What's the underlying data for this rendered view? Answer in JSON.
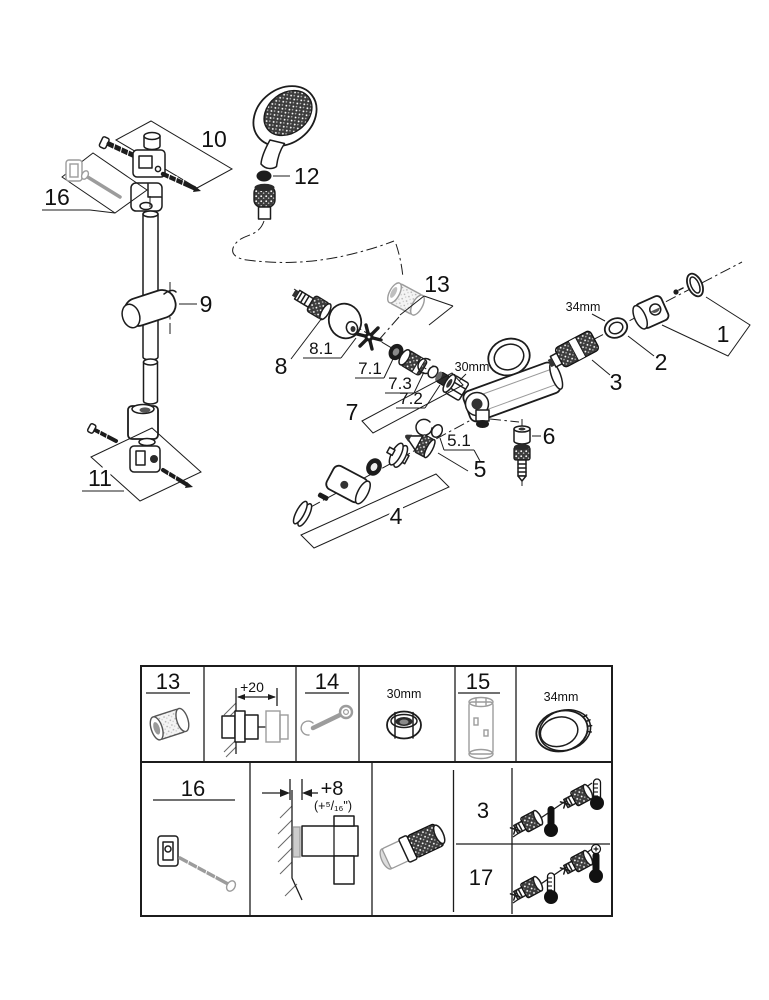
{
  "diagram": {
    "callouts": {
      "n1": "1",
      "n2": "2",
      "n3": "3",
      "n4": "4",
      "n5": "5",
      "n5_1": "5.1",
      "n6": "6",
      "n7": "7",
      "n7_1": "7.1",
      "n7_2": "7.2",
      "n7_3": "7.3",
      "n8": "8",
      "n8_1": "8.1",
      "n9": "9",
      "n10": "10",
      "n11": "11",
      "n12": "12",
      "n13": "13",
      "n16": "16"
    },
    "dimensions": {
      "size30": "30mm",
      "size34": "34mm"
    }
  },
  "table": {
    "row1": {
      "c13": "13",
      "dim20": "+20",
      "c14": "14",
      "size30": "30mm",
      "c15": "15",
      "size34": "34mm"
    },
    "row2": {
      "c16": "16",
      "dim8": "+8",
      "dim8_inch": "(+⁵/₁₆\")",
      "r3": "3",
      "r17": "17"
    }
  }
}
